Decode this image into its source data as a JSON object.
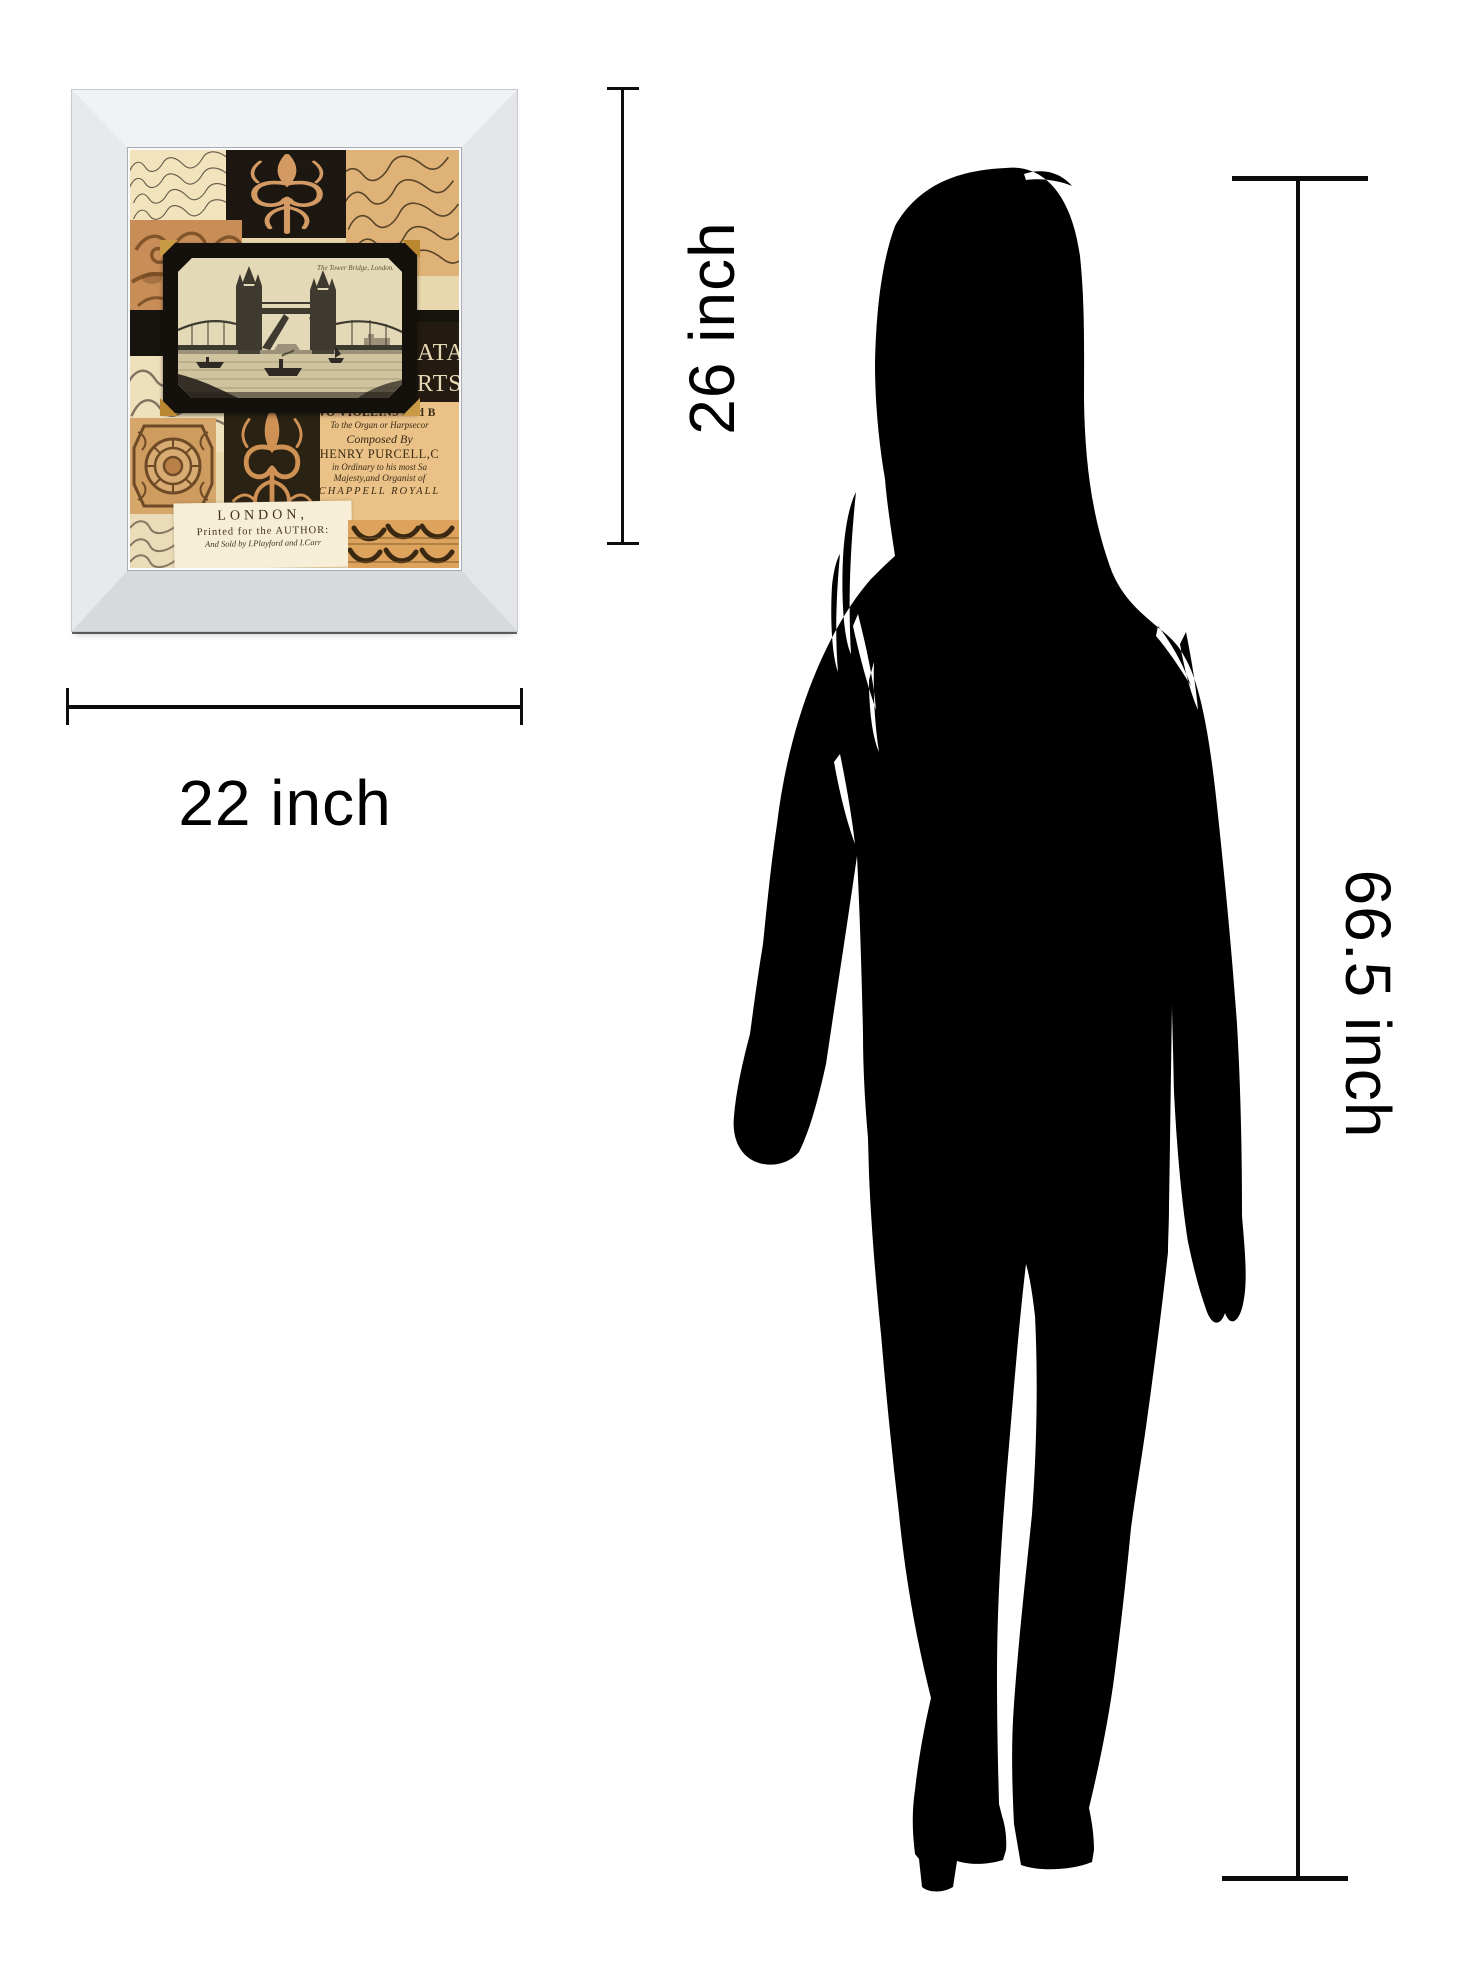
{
  "artwork": {
    "description": "mirror framed vintage London collage print",
    "postcard_caption": "The Tower Bridge, London.",
    "fragment_lines": [
      "ATA",
      "RTS"
    ],
    "concert_lines": [
      "TWO VIOLLINS And B",
      "To the Organ or Harpsecor",
      "Composed By",
      "HENRY PURCELL,C",
      "in Ordinary to his most Sa",
      "Majesty,and Organist of",
      "CHAPPELL ROYALL"
    ],
    "publisher_lines": [
      "LONDON,",
      "Printed for the AUTHOR:",
      "And Sold by I.Playford and I.Carr"
    ]
  },
  "dimensions": {
    "width_label": "22 inch",
    "height_label": "26 inch",
    "person_height_label": "66.5 inch"
  },
  "colors": {
    "background": "#ffffff",
    "silhouette": "#000000",
    "dimension_line": "#0d0d0d",
    "frame_mirror": "#e9ebee",
    "parchment": "#e9d8ae"
  }
}
